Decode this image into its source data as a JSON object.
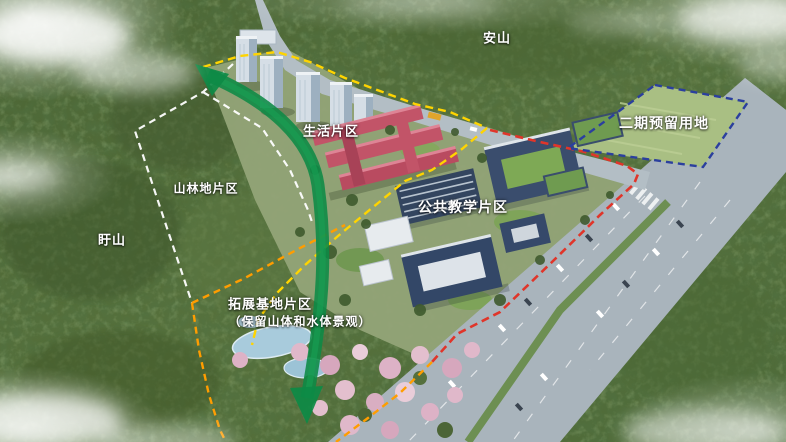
{
  "labels": {
    "mountain_north": "安山",
    "mountain_west": "盱山",
    "zone_living": "生活片区",
    "zone_forest": "山林地片区",
    "zone_teaching": "公共教学片区",
    "zone_expansion_line1": "拓展基地片区",
    "zone_expansion_line2": "（保留山体和水体景观）",
    "zone_phase2": "二期预留用地"
  },
  "boundary_colors": {
    "phase2_reserved_blue": "#2b3f9e",
    "campus_roadside_red": "#e0352a",
    "living_area_yellow": "#ffd400",
    "expansion_base_orange": "#ff9d00",
    "forest_zone_white": "#ffffff"
  },
  "landscape_axis_arrow_color": "#0d8a45"
}
